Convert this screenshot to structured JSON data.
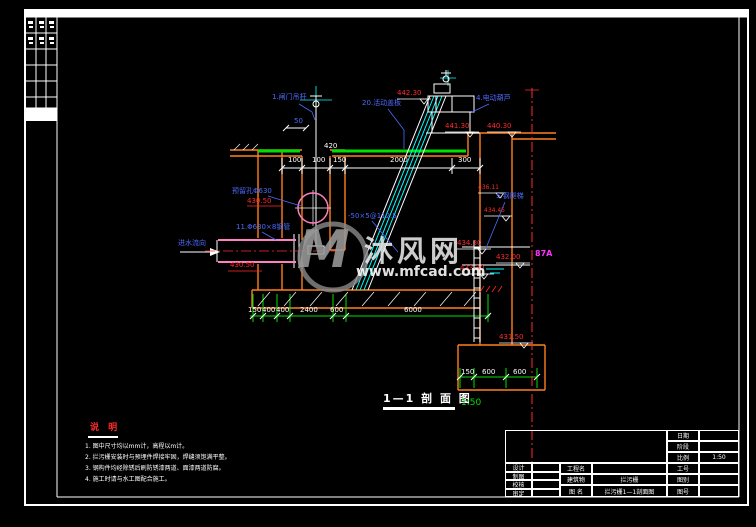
{
  "watermark": {
    "logo": "M",
    "site": "沐风网",
    "url": "www.mfcad.com"
  },
  "section": {
    "title": "1—1 剖 面 图",
    "scale": "1:50"
  },
  "notes": {
    "title": "说 明",
    "items": [
      "1. 图中尺寸均以mm计，高程以m计。",
      "2. 拦污栅安装时与预埋件焊接牢固，焊缝须饱满平整。",
      "3. 钢构件均经除锈后刷防锈漆两道、面漆两道防腐。",
      "4. 施工时请与水工图配合施工。"
    ]
  },
  "dims": {
    "top": [
      "100",
      "100",
      "150",
      "2000",
      "300"
    ],
    "vertical": "420",
    "cover_dim": "50",
    "bottom": [
      "150",
      "400",
      "400",
      "2400",
      "600",
      "6000"
    ],
    "bottom_right": [
      "150",
      "600",
      "600"
    ],
    "section_mark": "87A"
  },
  "elevations": [
    "442.30",
    "441.30",
    "440.30",
    "436.11",
    "434.45",
    "434.30",
    "433.30",
    "432.00",
    "431.50",
    "430.50",
    "430.50"
  ],
  "leaders": [
    "1.闸门吊杆",
    "20.活动盖板",
    "4.电动葫芦",
    "5.钢爬梯",
    "11.Φ630×8钢管",
    "进水流向",
    "预留孔Φ630",
    "-50×5@112.5"
  ],
  "title_block": {
    "sign_rows": [
      {
        "label": "设计",
        "value": ""
      },
      {
        "label": "制图",
        "value": ""
      },
      {
        "label": "校核",
        "value": ""
      },
      {
        "label": "审定",
        "value": ""
      }
    ],
    "mid_rows": [
      {
        "label": "工程名",
        "value": ""
      },
      {
        "label": "建筑物",
        "value": "拦污栅"
      },
      {
        "label": "图 名",
        "value": "拦污栅1—1剖面图"
      }
    ],
    "right_rows": [
      {
        "label": "日期",
        "value": ""
      },
      {
        "label": "阶段",
        "value": ""
      },
      {
        "label": "比例",
        "value": "1:50"
      },
      {
        "label": "工号",
        "value": ""
      },
      {
        "label": "图别",
        "value": ""
      },
      {
        "label": "图号",
        "value": ""
      }
    ]
  }
}
